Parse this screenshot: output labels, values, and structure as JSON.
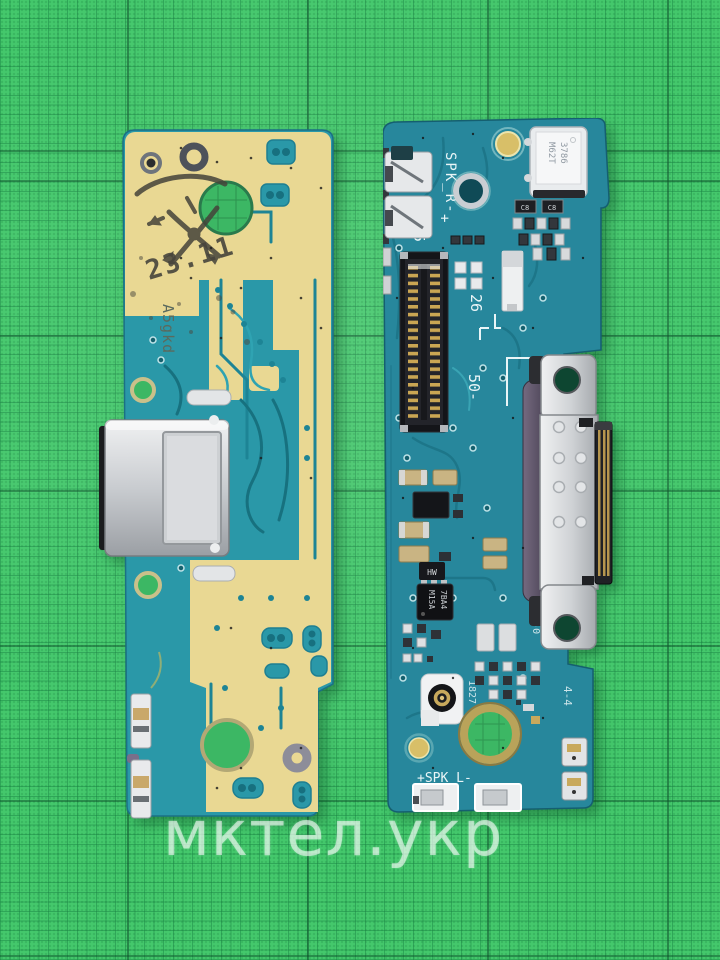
{
  "watermark": {
    "text": "мктел.укр"
  },
  "mat": {
    "base_color": "#44c86c",
    "fine_line_color": "#167e40",
    "major_line_color": "#0d522b"
  },
  "left_board": {
    "board_color": "#2a98a8",
    "coverlay_color": "#e9d893",
    "stamp_date": "23.11",
    "silkscreen_marking": "A5gkd"
  },
  "right_board": {
    "board_color": "#27879c",
    "silkscreen": {
      "spk_r": "SPK_R-",
      "plus": "+",
      "pin_25": "25",
      "pin_26": "26",
      "pin_50": "50-",
      "spk_l": "+SPK_L-",
      "flammability": "94V-0",
      "code_gfn": "GF-N",
      "date_code": "1827",
      "code_44": "4-4"
    },
    "components": {
      "mic_line1": "M62T",
      "mic_line2": "3786",
      "ic_line1": "M15A",
      "ic_line2": "7BA4",
      "transistor_marking": "HW",
      "cap_label_1": "C8",
      "cap_label_2": "C8"
    }
  }
}
